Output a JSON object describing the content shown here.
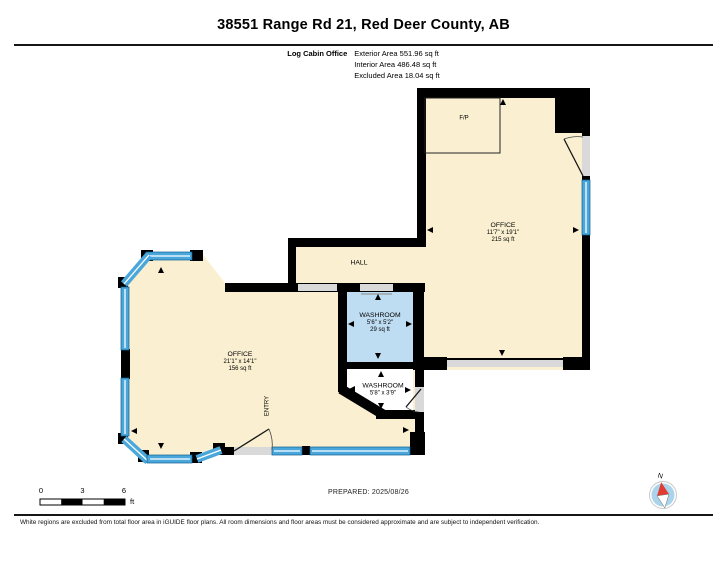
{
  "header": {
    "title": "38551 Range Rd 21, Red Deer County, AB"
  },
  "summary": {
    "floor_label": "Log Cabin Office",
    "exterior_area": "Exterior Area 551.96 sq ft",
    "interior_area": "Interior Area 486.48 sq ft",
    "excluded_area": "Excluded Area 18.04 sq ft"
  },
  "rooms": {
    "office_right": {
      "name": "OFFICE",
      "dimensions": "11'7\" x 19'1\"",
      "area": "215 sq ft"
    },
    "office_left": {
      "name": "OFFICE",
      "dimensions": "21'1\" x 14'1\"",
      "area": "156 sq ft"
    },
    "hall": {
      "name": "HALL"
    },
    "washroom_upper": {
      "name": "WASHROOM",
      "dimensions": "5'6\" x 5'2\"",
      "area": "29 sq ft"
    },
    "washroom_lower": {
      "name": "WASHROOM",
      "dimensions": "5'8\" x 3'9\""
    },
    "entry": {
      "name": "ENTRY"
    },
    "fireplace": {
      "name": "F/P"
    }
  },
  "footer": {
    "scale": {
      "ticks": [
        "0",
        "3",
        "6"
      ],
      "unit": "ft"
    },
    "prepared": "PREPARED: 2025/08/26",
    "compass_north": "N",
    "disclaimer": "White regions are excluded from total floor area in iGUIDE floor plans. All room dimensions and floor areas must be considered approximate and are subject to independent verification."
  },
  "colors": {
    "floor": "#FAF0D1",
    "washroom": "#BEDCF2",
    "excluded": "#FFFFFF",
    "wall": "#000000",
    "opening": "#D9D9D9",
    "window": "#4AA7DB",
    "window_line": "#FFFFFF",
    "compass_face": "#A9D4EB",
    "compass_needle": "#E03C31"
  }
}
